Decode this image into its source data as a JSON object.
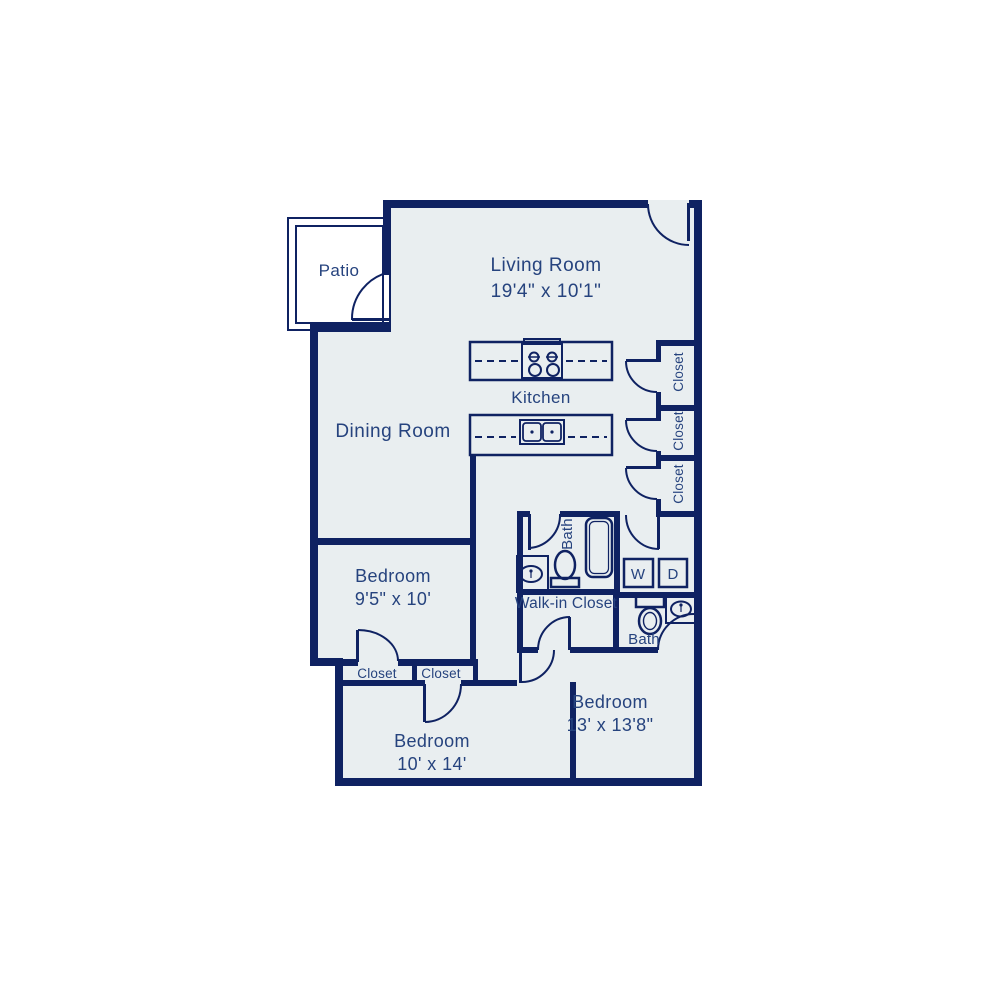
{
  "palette": {
    "wall": "#0f2262",
    "label_text": "#26437e",
    "interior_fill": "#e9eef0",
    "patio_fill": "#ffffff",
    "page_background": "#ffffff"
  },
  "rooms": {
    "patio": {
      "label": "Patio"
    },
    "living_room": {
      "label": "Living Room",
      "dimensions": "19'4\" x 10'1\""
    },
    "dining_room": {
      "label": "Dining Room"
    },
    "kitchen": {
      "label": "Kitchen"
    },
    "bedroom_1": {
      "label": "Bedroom",
      "dimensions": "9'5\" x 10'"
    },
    "bedroom_2": {
      "label": "Bedroom",
      "dimensions": "10' x 14'"
    },
    "bedroom_3": {
      "label": "Bedroom",
      "dimensions": "13' x 13'8\""
    },
    "bath_1": {
      "label": "Bath"
    },
    "bath_2": {
      "label": "Bath"
    },
    "walk_in_closet": {
      "label": "Walk-in Closet"
    },
    "hall_closet_top": {
      "label": "Closet"
    },
    "hall_closet_middle": {
      "label": "Closet"
    },
    "hall_closet_bottom": {
      "label": "Closet"
    },
    "bedroom_1_closet": {
      "label": "Closet"
    },
    "bedroom_2_closet": {
      "label": "Closet"
    },
    "washer": {
      "label": "W"
    },
    "dryer": {
      "label": "D"
    }
  }
}
